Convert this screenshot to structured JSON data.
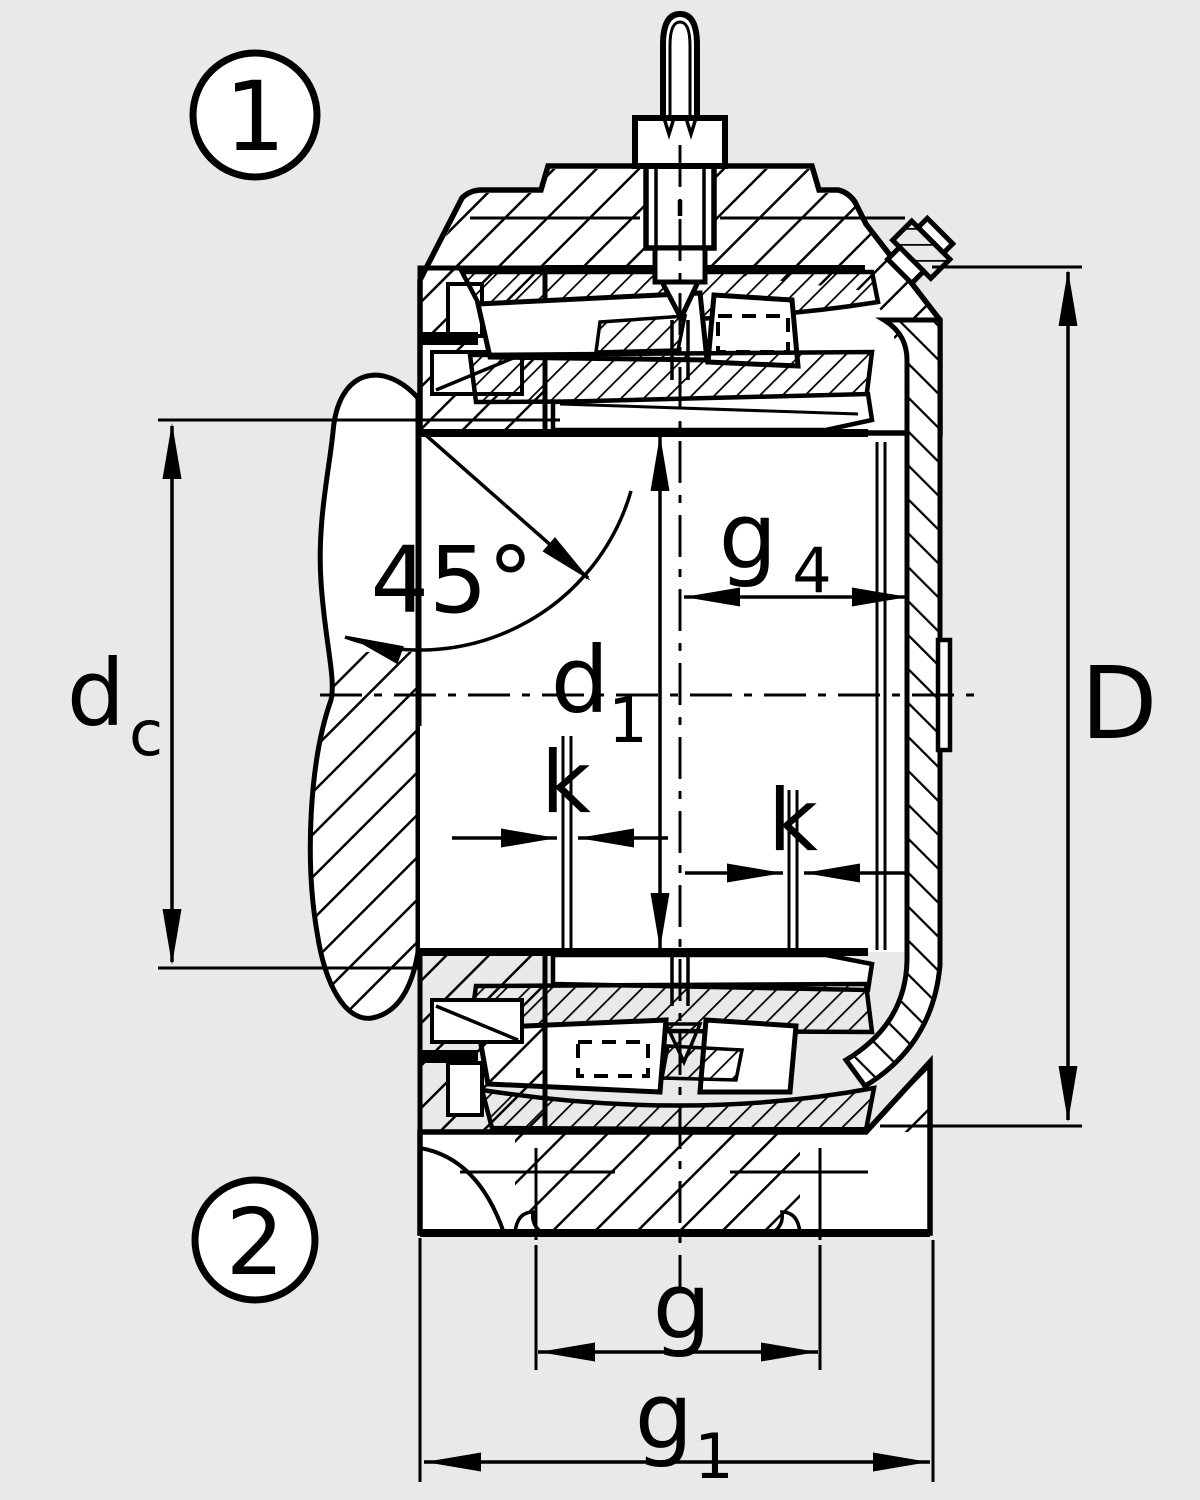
{
  "figure": {
    "type": "technical-section-drawing",
    "subject": "Split plummer block housing with double-row spherical roller bearing, axial section",
    "background_color": "#e9e9e9",
    "line_color": "#000000",
    "callouts": [
      {
        "id": "callout-1",
        "label": "1"
      },
      {
        "id": "callout-2",
        "label": "2"
      }
    ],
    "dimensions": {
      "angle_45": {
        "label": "45°"
      },
      "d_c": {
        "base": "d",
        "subscript": "c"
      },
      "d_1": {
        "base": "d",
        "subscript": "1"
      },
      "g_4": {
        "base": "g",
        "subscript": "4"
      },
      "k_left": {
        "label": "k"
      },
      "k_right": {
        "label": "k"
      },
      "D": {
        "label": "D"
      },
      "g": {
        "label": "g"
      },
      "g_1": {
        "base": "g",
        "subscript": "1"
      }
    }
  }
}
